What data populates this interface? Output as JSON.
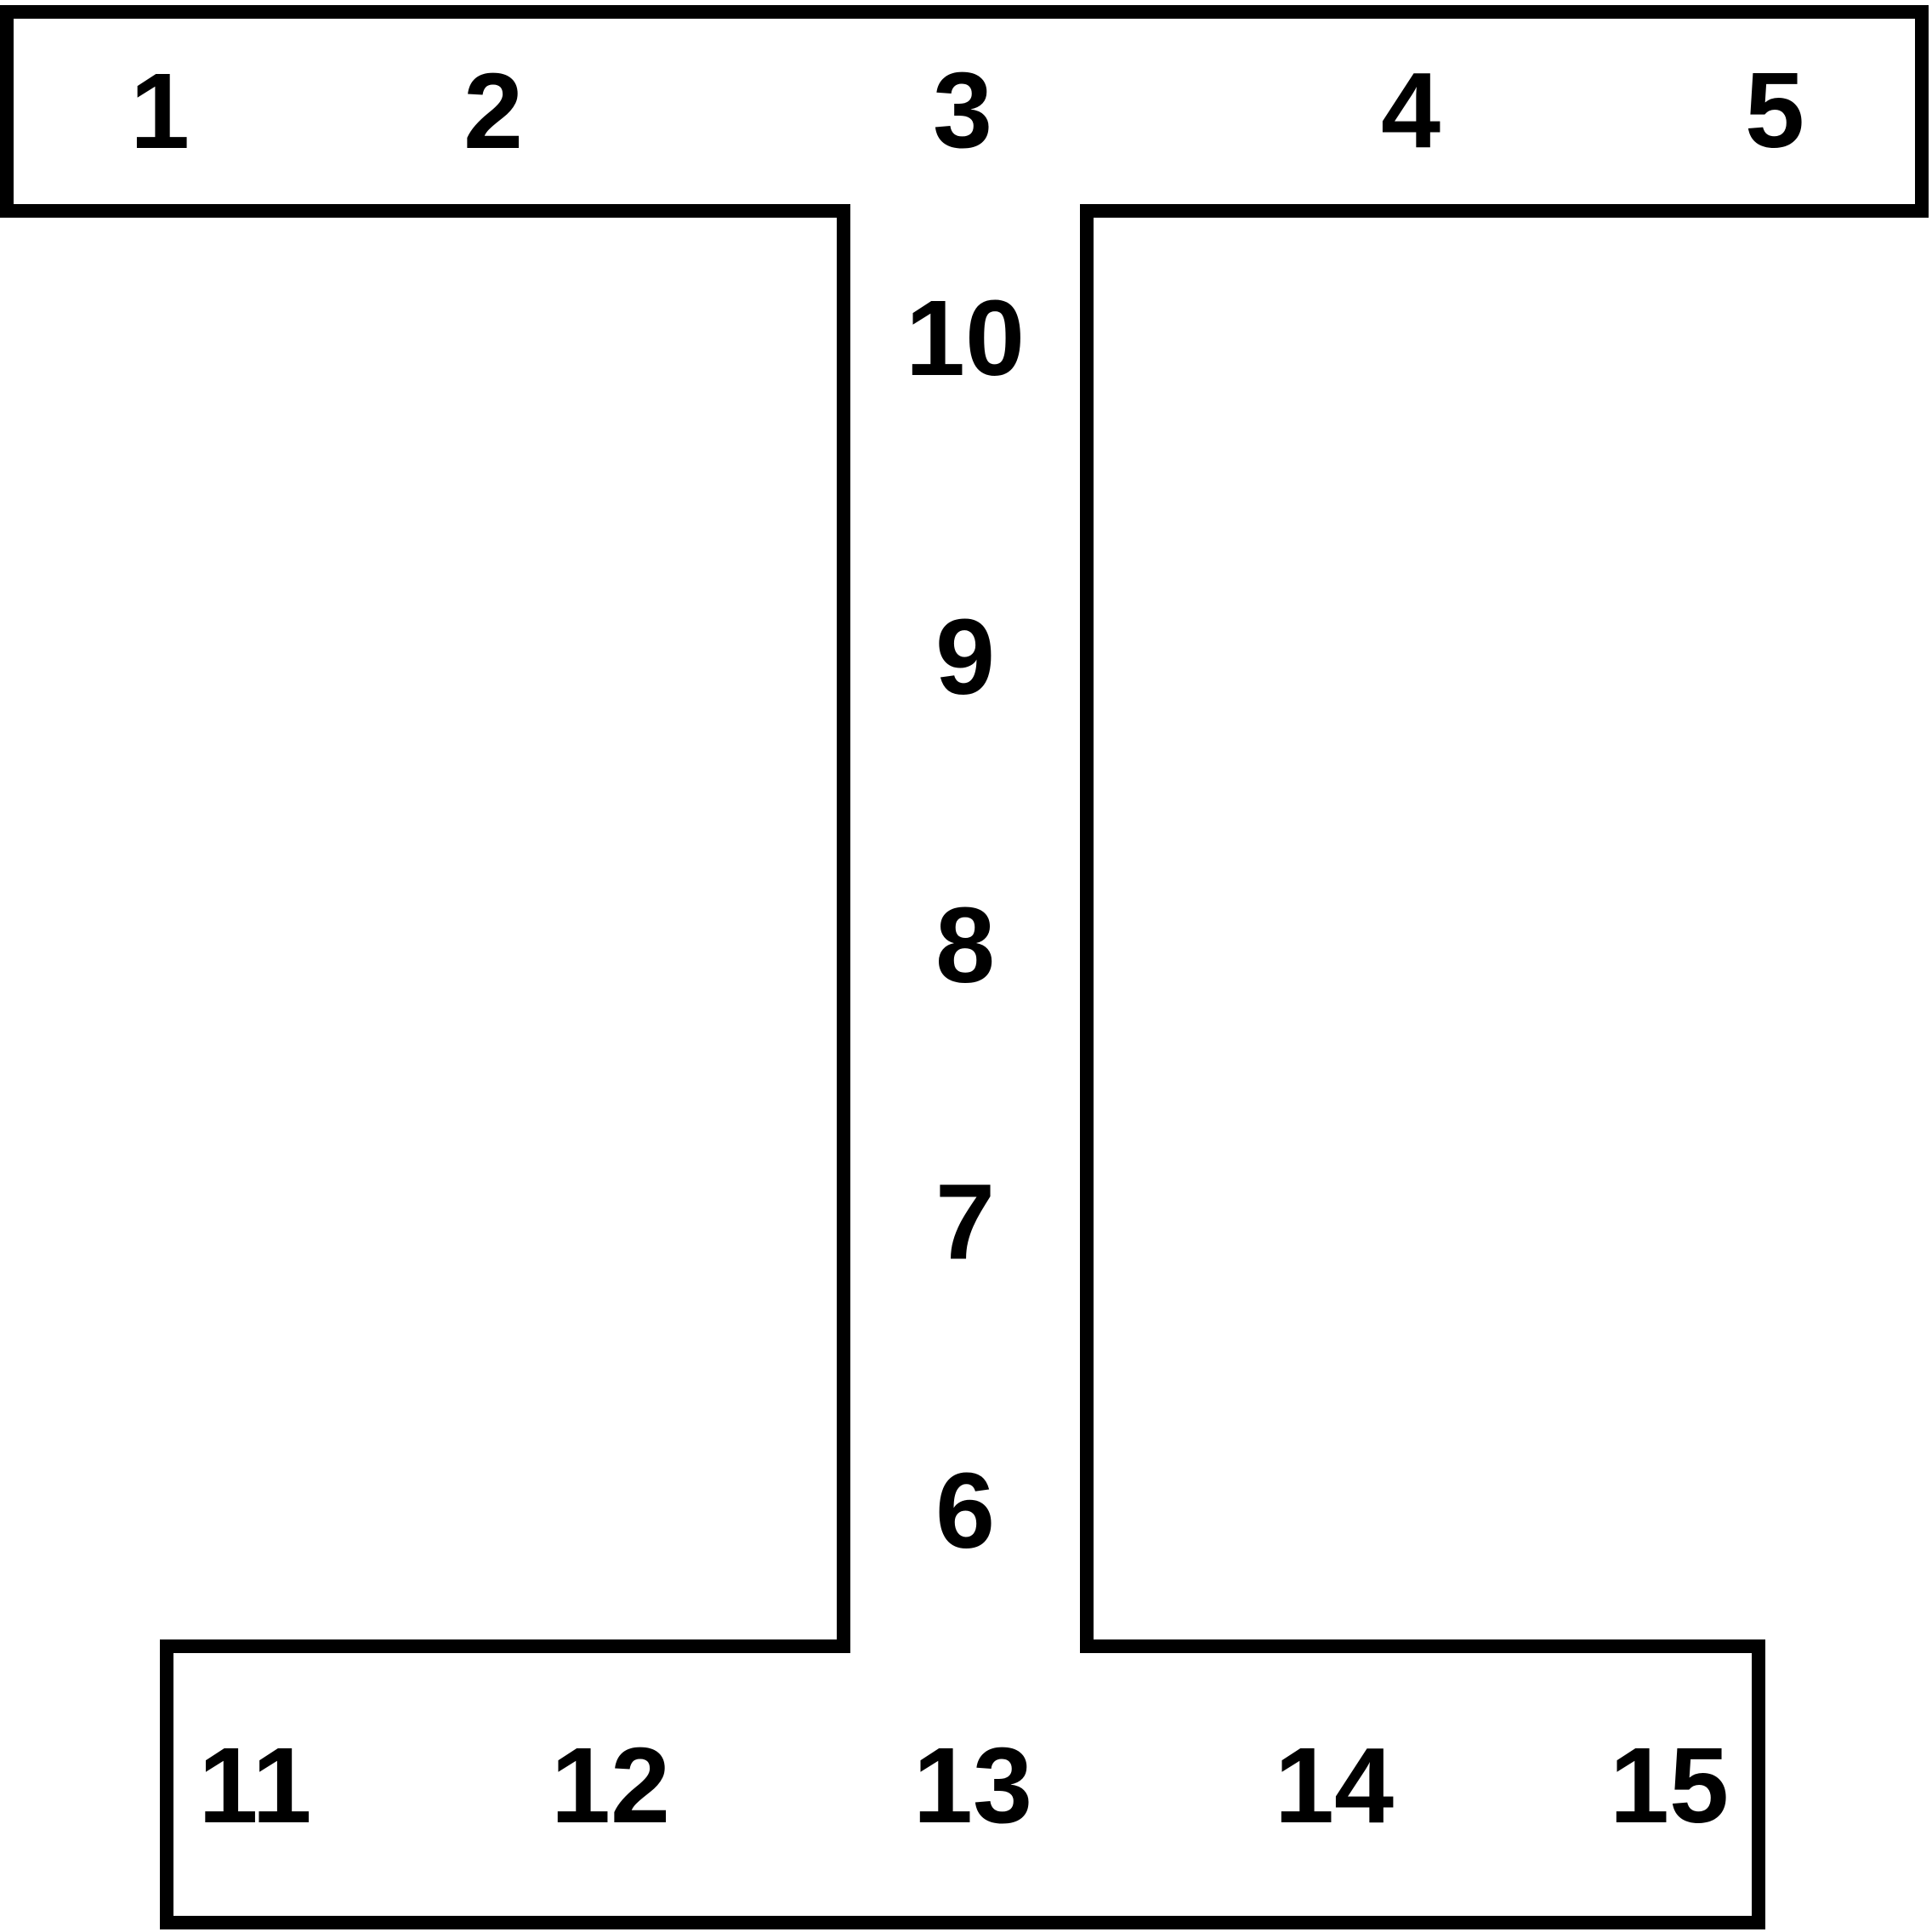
{
  "diagram": {
    "shape": "i-beam-cross-section",
    "background_color": "#ffffff",
    "stroke_color": "#000000",
    "labels": {
      "top_flange": [
        "1",
        "2",
        "3",
        "4",
        "5"
      ],
      "web_top_to_bottom": [
        "10",
        "9",
        "8",
        "7",
        "6"
      ],
      "bottom_flange": [
        "11",
        "12",
        "13",
        "14",
        "15"
      ]
    }
  }
}
